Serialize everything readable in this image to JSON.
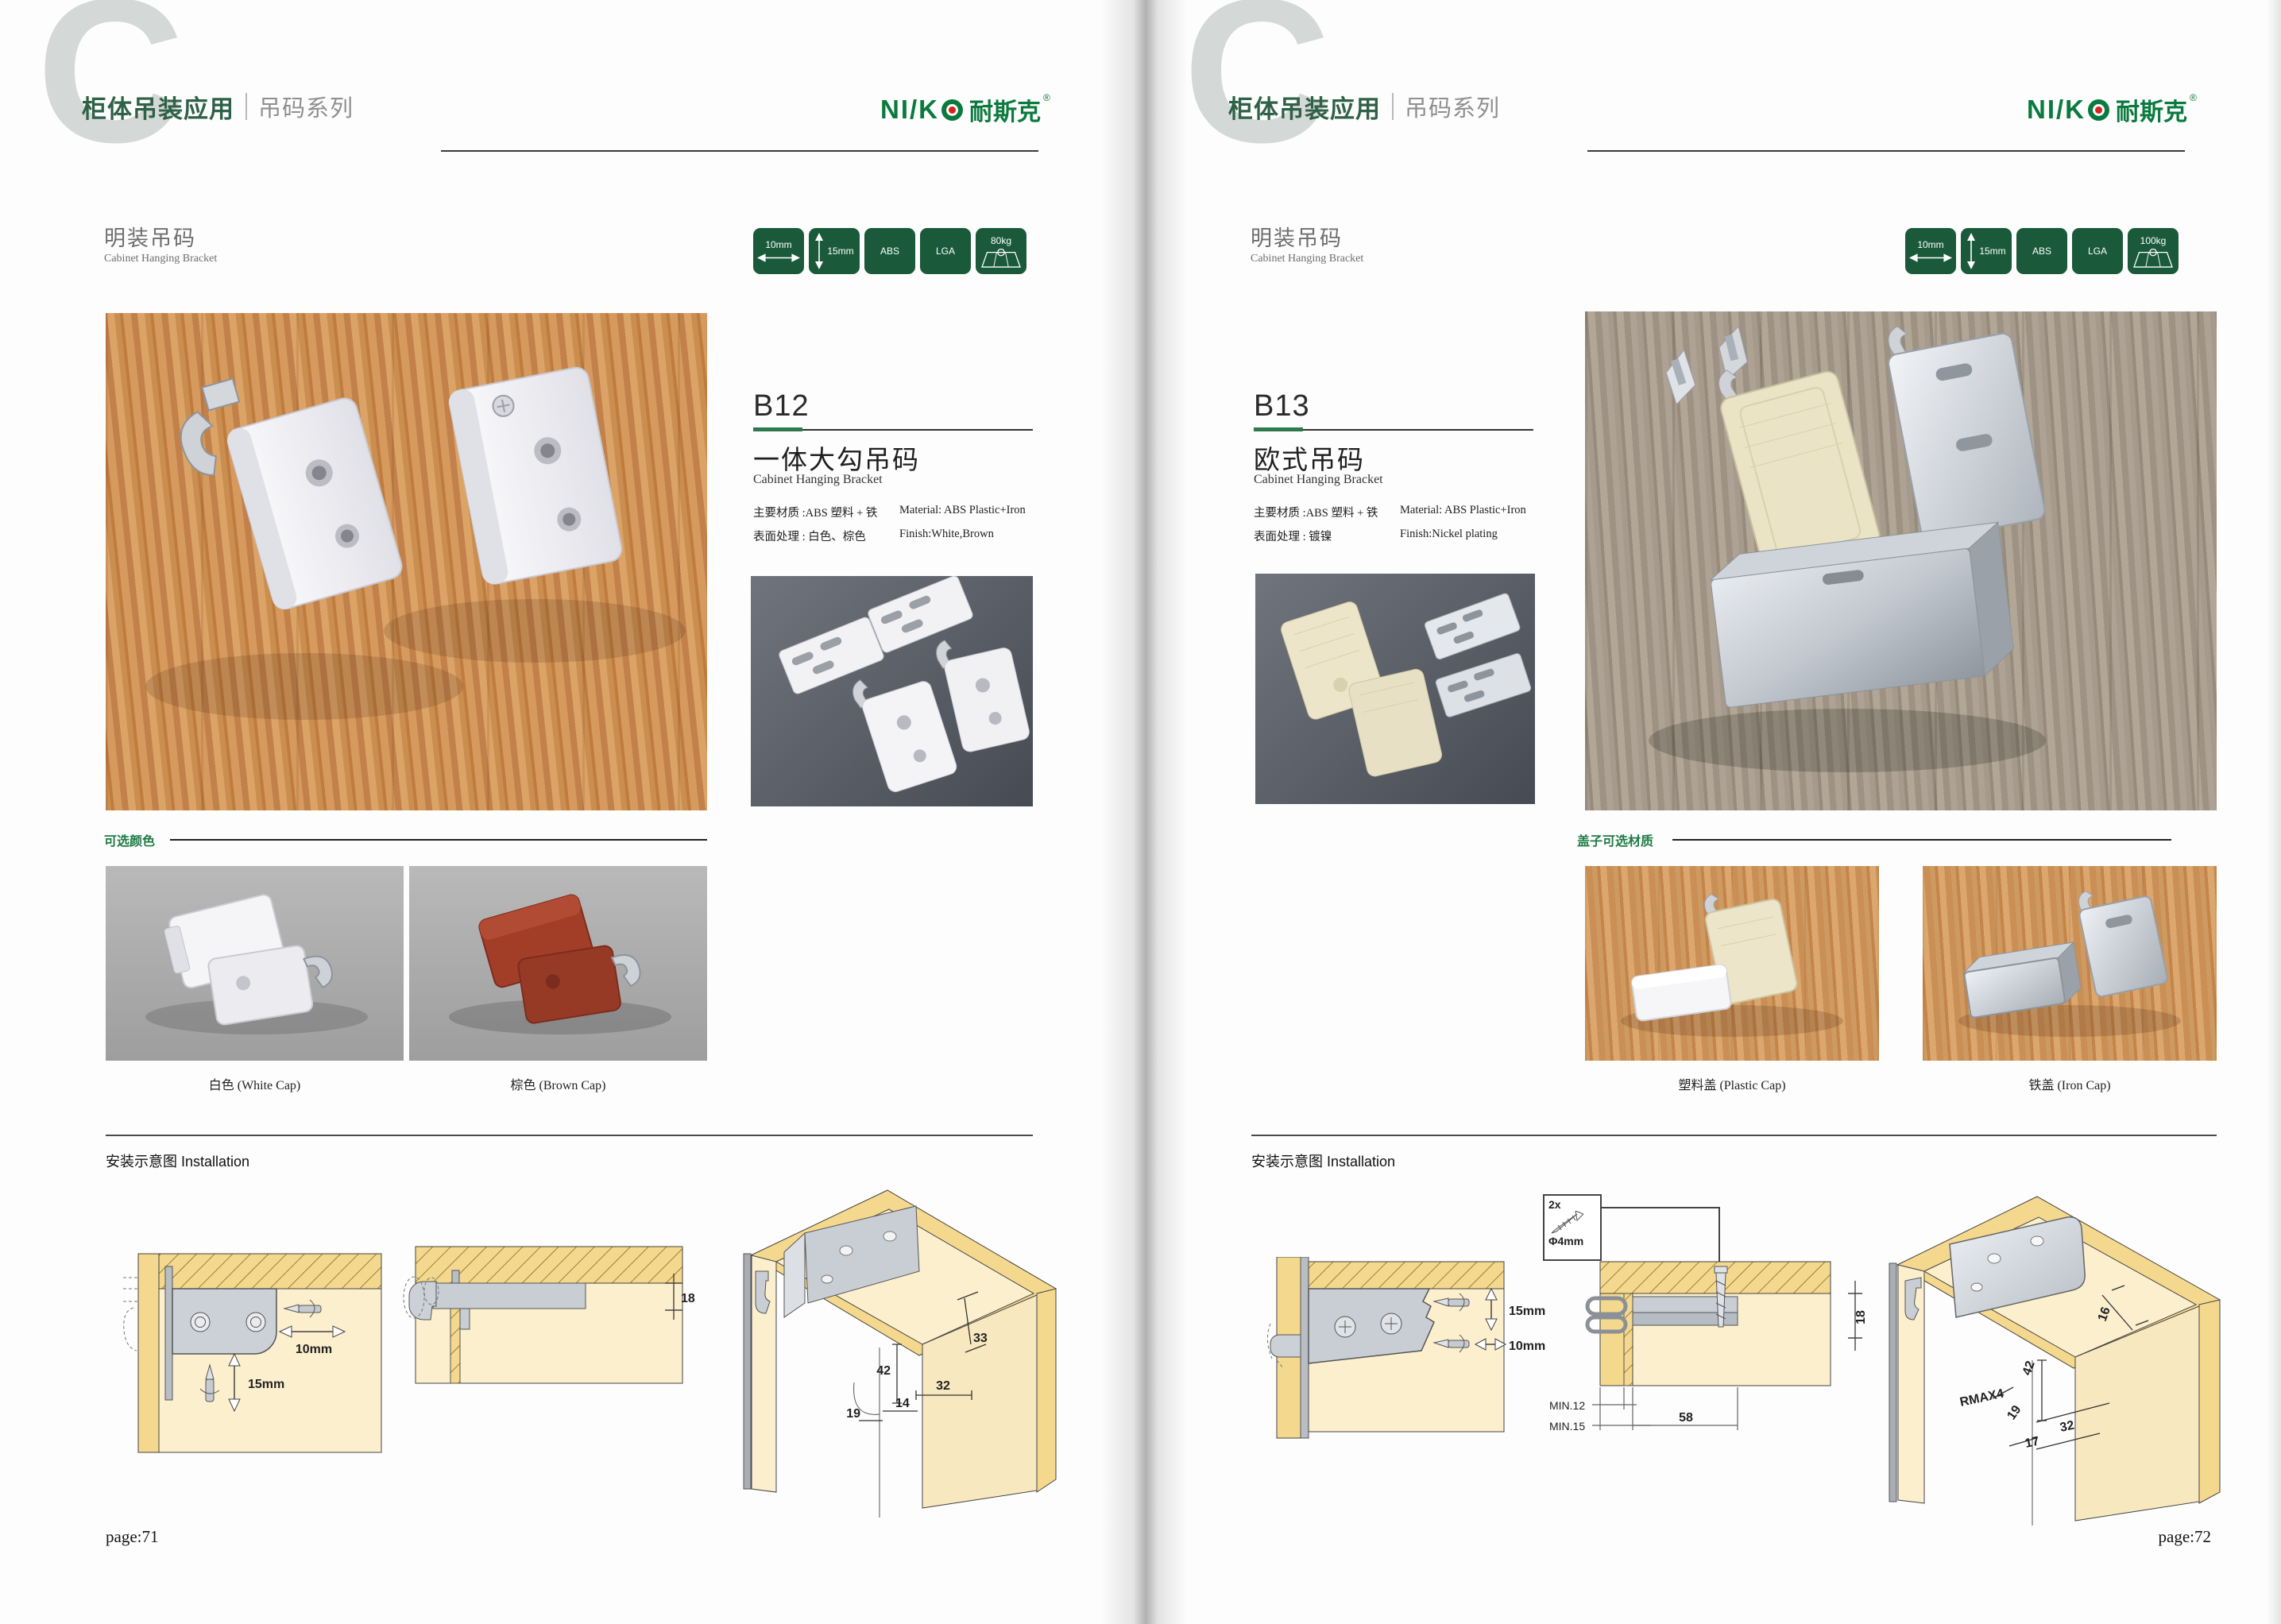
{
  "header": {
    "chapter_letter": "C",
    "title_cn": "柜体吊装应用",
    "series_cn": "吊码系列",
    "logo": {
      "latin": "NI/K",
      "cn": "耐斯克",
      "reg": "®"
    }
  },
  "badges": {
    "width_label": "10mm",
    "height_label": "15mm",
    "material_label": "ABS",
    "cert_label": "LGA"
  },
  "left_page": {
    "section_title_cn": "明装吊码",
    "section_title_en": "Cabinet Hanging Bracket",
    "load_label": "80kg",
    "product": {
      "code": "B12",
      "name_cn": "一体大勾吊码",
      "name_en": "Cabinet Hanging Bracket",
      "material_cn": "主要材质 :ABS 塑料 + 铁",
      "material_en": "Material: ABS Plastic+Iron",
      "finish_cn": "表面处理 : 白色、棕色",
      "finish_en": "Finish:White,Brown"
    },
    "options_label": "可选颜色",
    "option_captions": [
      "白色 (White Cap)",
      "棕色 (Brown Cap)"
    ],
    "installation_label": "安装示意图 Installation",
    "diagram1": {
      "horiz": "10mm",
      "vert": "15mm"
    },
    "diagram2": {
      "depth": "18"
    },
    "diagram3": {
      "d33": "33",
      "d42": "42",
      "d32": "32",
      "d14": "14",
      "d19": "19"
    },
    "page_number": "page:71"
  },
  "right_page": {
    "section_title_cn": "明装吊码",
    "section_title_en": "Cabinet Hanging Bracket",
    "load_label": "100kg",
    "product": {
      "code": "B13",
      "name_cn": "欧式吊码",
      "name_en": "Cabinet Hanging Bracket",
      "material_cn": "主要材质 :ABS 塑料 + 铁",
      "material_en": "Material: ABS Plastic+Iron",
      "finish_cn": "表面处理 : 镀镍",
      "finish_en": "Finish:Nickel plating"
    },
    "options_label": "盖子可选材质",
    "option_captions": [
      "塑料盖 (Plastic Cap)",
      "铁盖 (Iron Cap)"
    ],
    "installation_label": "安装示意图 Installation",
    "screw_box": {
      "count": "2x",
      "dia": "Φ4mm"
    },
    "diagram1": {
      "vert": "15mm",
      "horiz": "10mm"
    },
    "diagram2": {
      "depth": "18",
      "min1": "MIN.12",
      "min2": "MIN.15",
      "d58": "58"
    },
    "diagram3": {
      "rmax": "RMAX4",
      "d16": "16",
      "d42": "42",
      "d19": "19",
      "d32": "32",
      "d17": "17"
    },
    "page_number": "page:72"
  },
  "colors": {
    "brand_green": "#0a7a3e",
    "badge_green": "#1a5a3a",
    "accent_green": "#2e7a4c",
    "header_green": "#2f6147",
    "wood_warm": "#c98a4e",
    "wood_gray": "#a0968a",
    "diagram_tan": "#f4d88e",
    "diagram_cream": "#fcefcd",
    "bracket_red": "#9f3c26",
    "logo_red_dot": "#d6231f"
  }
}
